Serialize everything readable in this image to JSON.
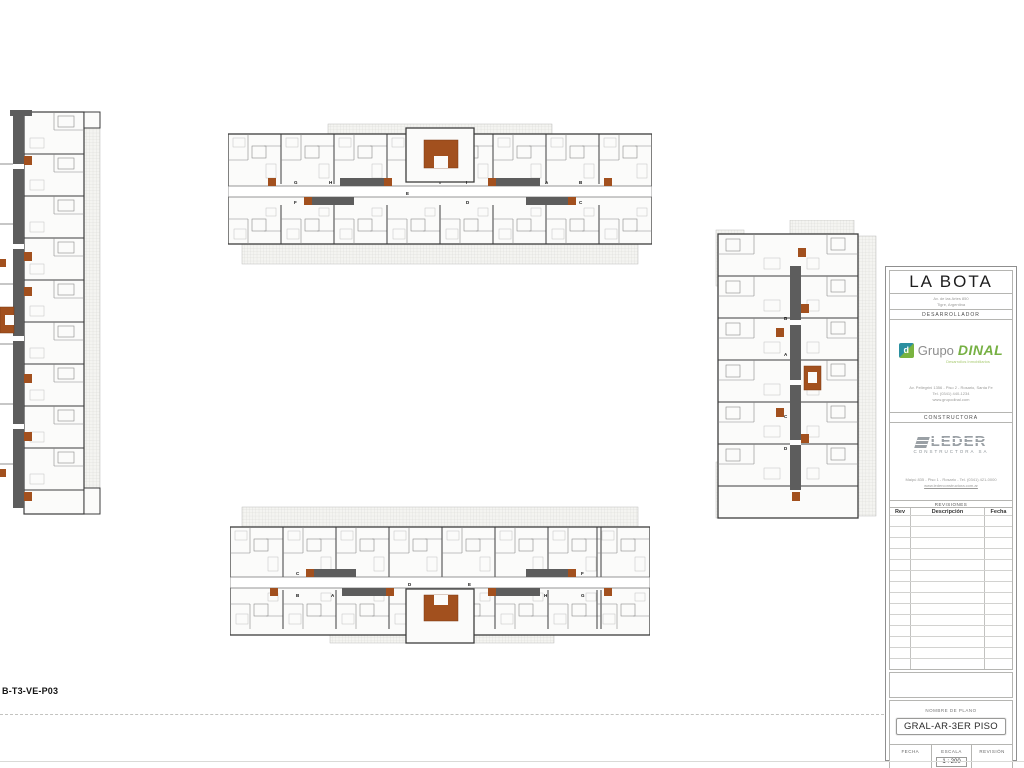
{
  "sheet": {
    "code": "B-T3-VE-P03"
  },
  "title_block": {
    "project_name": "LA BOTA",
    "project_address_line1": "Av. de las Artes 850",
    "project_address_line2": "Tigre, Argentina",
    "developer_section_label": "DESARROLLADOR",
    "developer": {
      "word1": "Grupo",
      "word2": "DINAL",
      "icon_letter": "d",
      "tagline": "Desarrollos Inmobiliarios",
      "address_line1": "Av. Pellegrini 1356 - Piso 2 - Rosario, Santa Fe",
      "address_line2": "Tel. (0341) 440-1234",
      "address_line3": "www.grupodinal.com"
    },
    "constructor_section_label": "CONSTRUCTORA",
    "constructor": {
      "name": "LEDER",
      "subtitle": "CONSTRUCTORA SA",
      "address_line1": "Maipú 835 - Piso 1 - Rosario - Tel. (0341) 421-0000",
      "address_line2": "www.lederconstructora.com.ar"
    },
    "revisions": {
      "title": "REVISIONES",
      "col_rev": "Rev",
      "col_desc": "Descripción",
      "col_fecha": "Fecha"
    },
    "plan_name_label": "NOMBRE DE PLANO",
    "plan_name": "GRAL-AR-3ER PISO",
    "footer": {
      "fecha_label": "FECHA",
      "escala_label": "ESCALA",
      "escala_value": "1 : 200",
      "revision_label": "REVISIÓN"
    }
  },
  "plans": {
    "top": {
      "unit_labels": [
        "G",
        "F",
        "H",
        "E",
        "I",
        "D",
        "A",
        "B",
        "C"
      ]
    },
    "bottom": {
      "unit_labels": [
        "C",
        "B",
        "A",
        "D",
        "E",
        "H",
        "F",
        "G"
      ]
    },
    "right": {
      "unit_labels": [
        "B",
        "A",
        "C",
        "D"
      ]
    }
  },
  "colors": {
    "stair_orange": "#a2501e",
    "corridor_gray": "#5d5d5d",
    "dinal_green": "#76b043",
    "dinal_teal": "#2a8fa0",
    "leder_gray": "#9aa0a5"
  }
}
